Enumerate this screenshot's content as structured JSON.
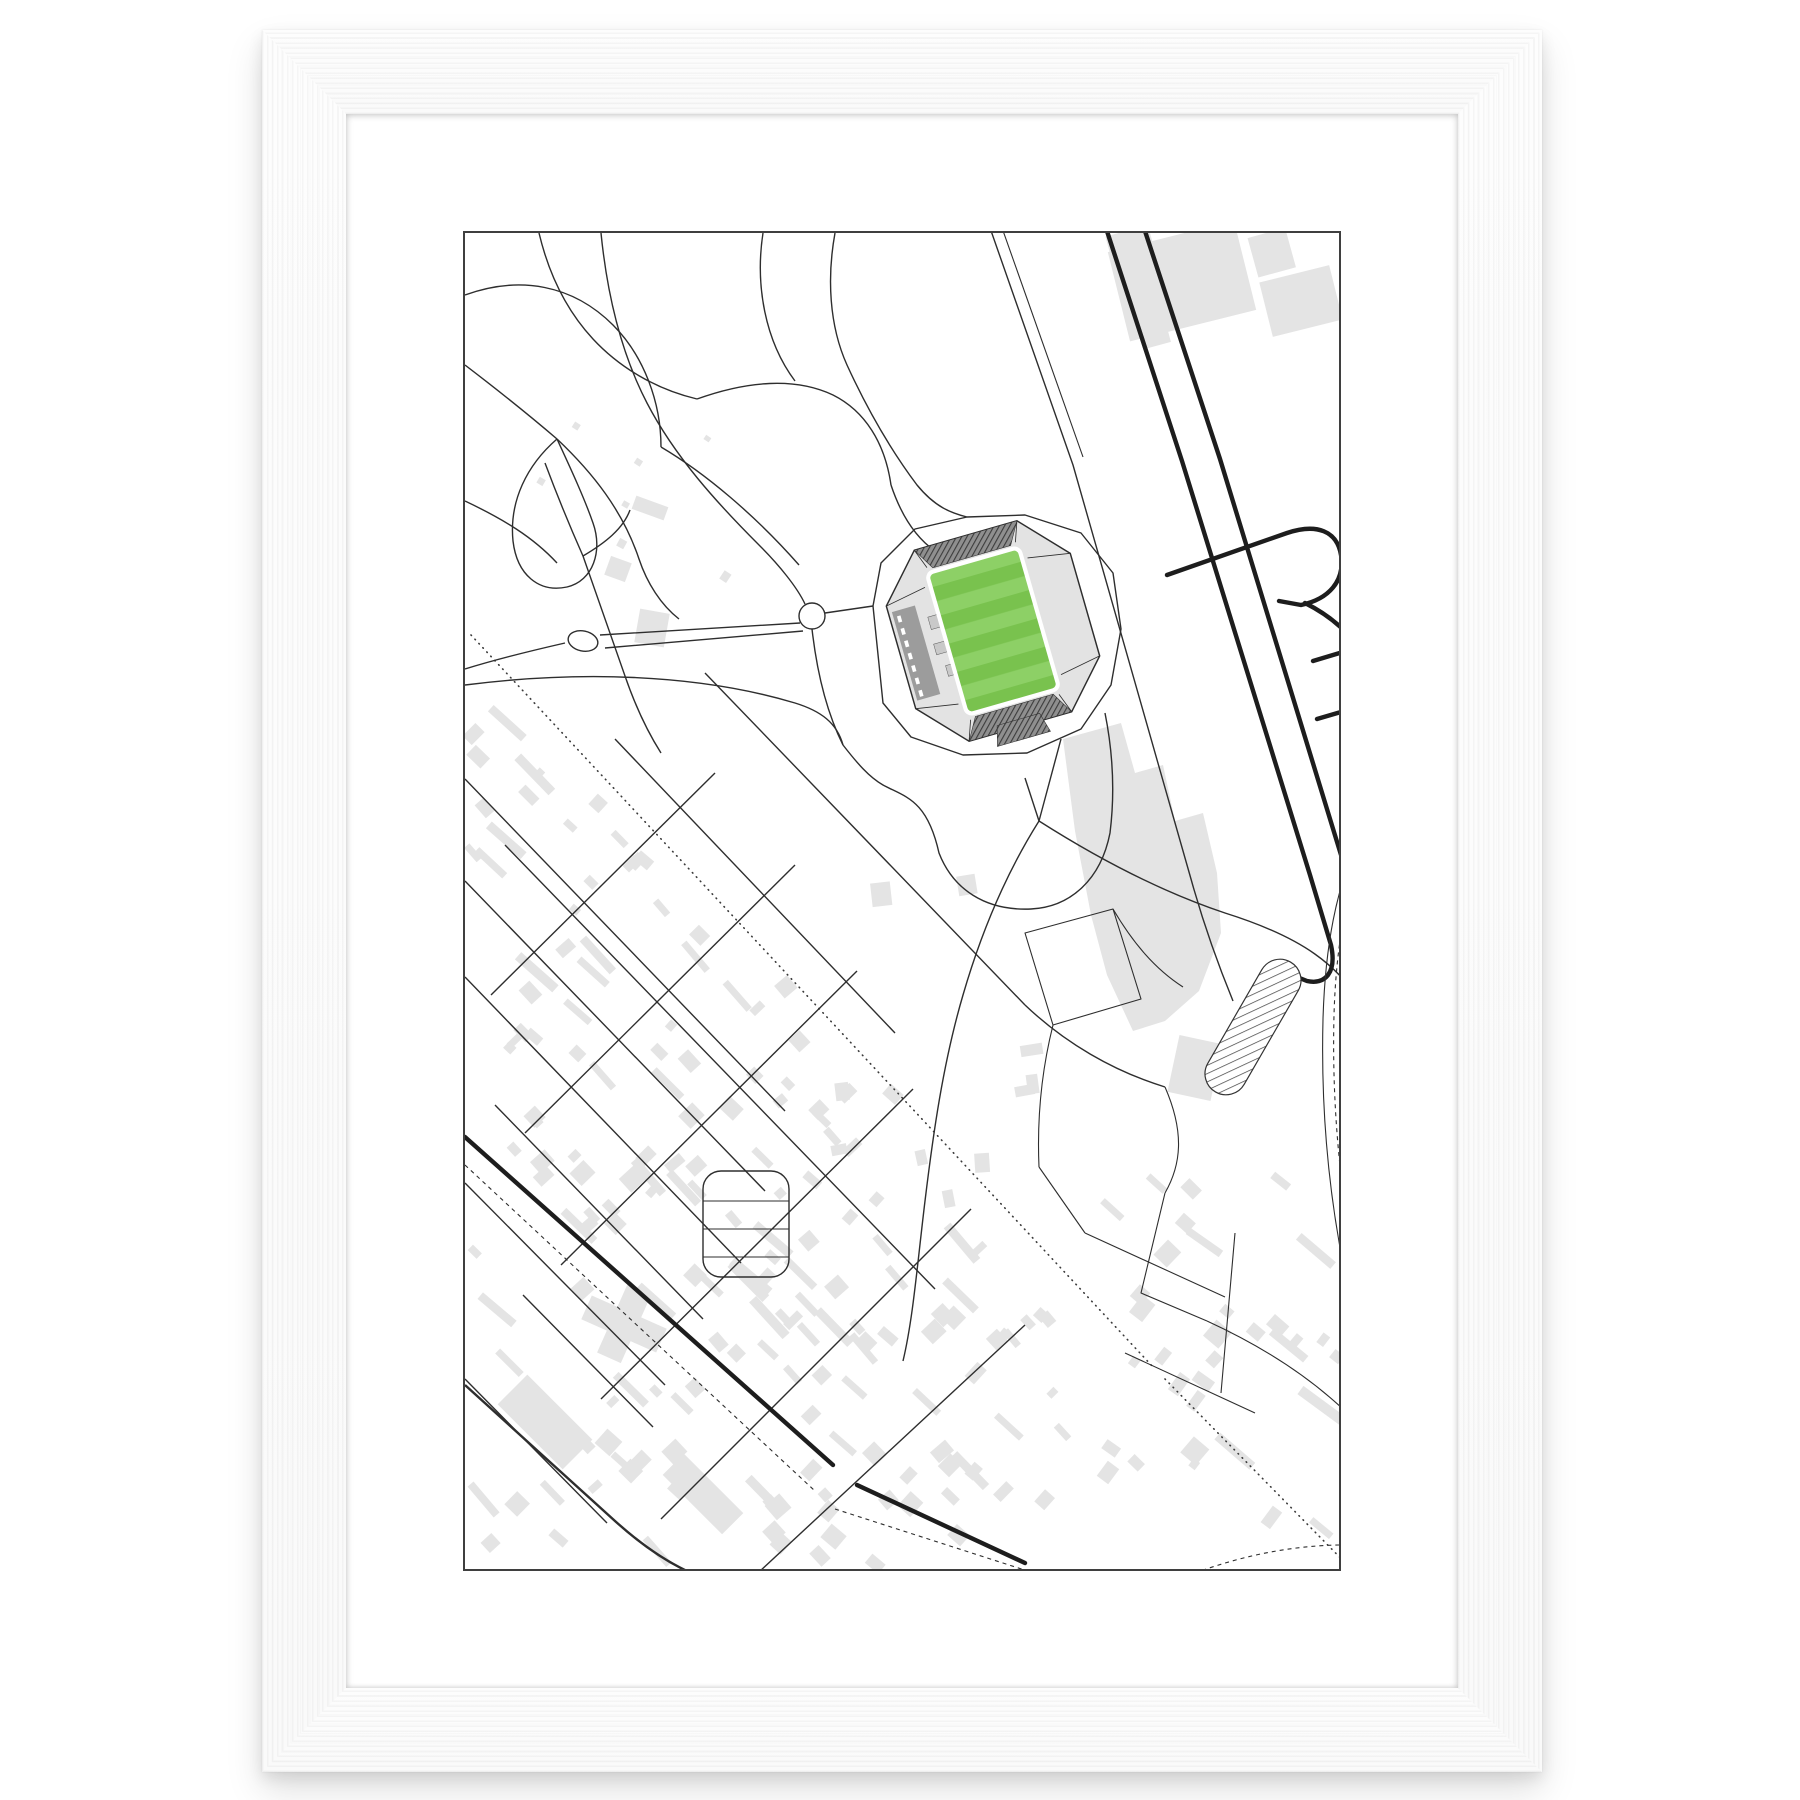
{
  "poster": {
    "title": "FREIBURG",
    "coordinates": "48° 1' 17.5\" N  7° 49' 48.0\" E",
    "brand": "playgroundplan°",
    "info": {
      "heading": "INFORMATION",
      "rows": [
        {
          "label": "architect",
          "value": "hpp"
        },
        {
          "label": "year",
          "value": "2021"
        },
        {
          "label": "location",
          "value": "suwonallee"
        },
        {
          "label": "capacity",
          "value": "34 700"
        },
        {
          "label": "surface",
          "value": "natural turf"
        },
        {
          "label": "field size",
          "value": "105 m × 68 m"
        }
      ]
    },
    "colors": {
      "pitch_green": "#79c24e",
      "pitch_green_light": "#8dd066",
      "map_ink": "#2e2e2e",
      "road_dark": "#1d1d1d",
      "building_gray": "#e4e4e4",
      "stand_gray": "#9c9c9c",
      "frame_border": "#3f3f3f"
    }
  }
}
